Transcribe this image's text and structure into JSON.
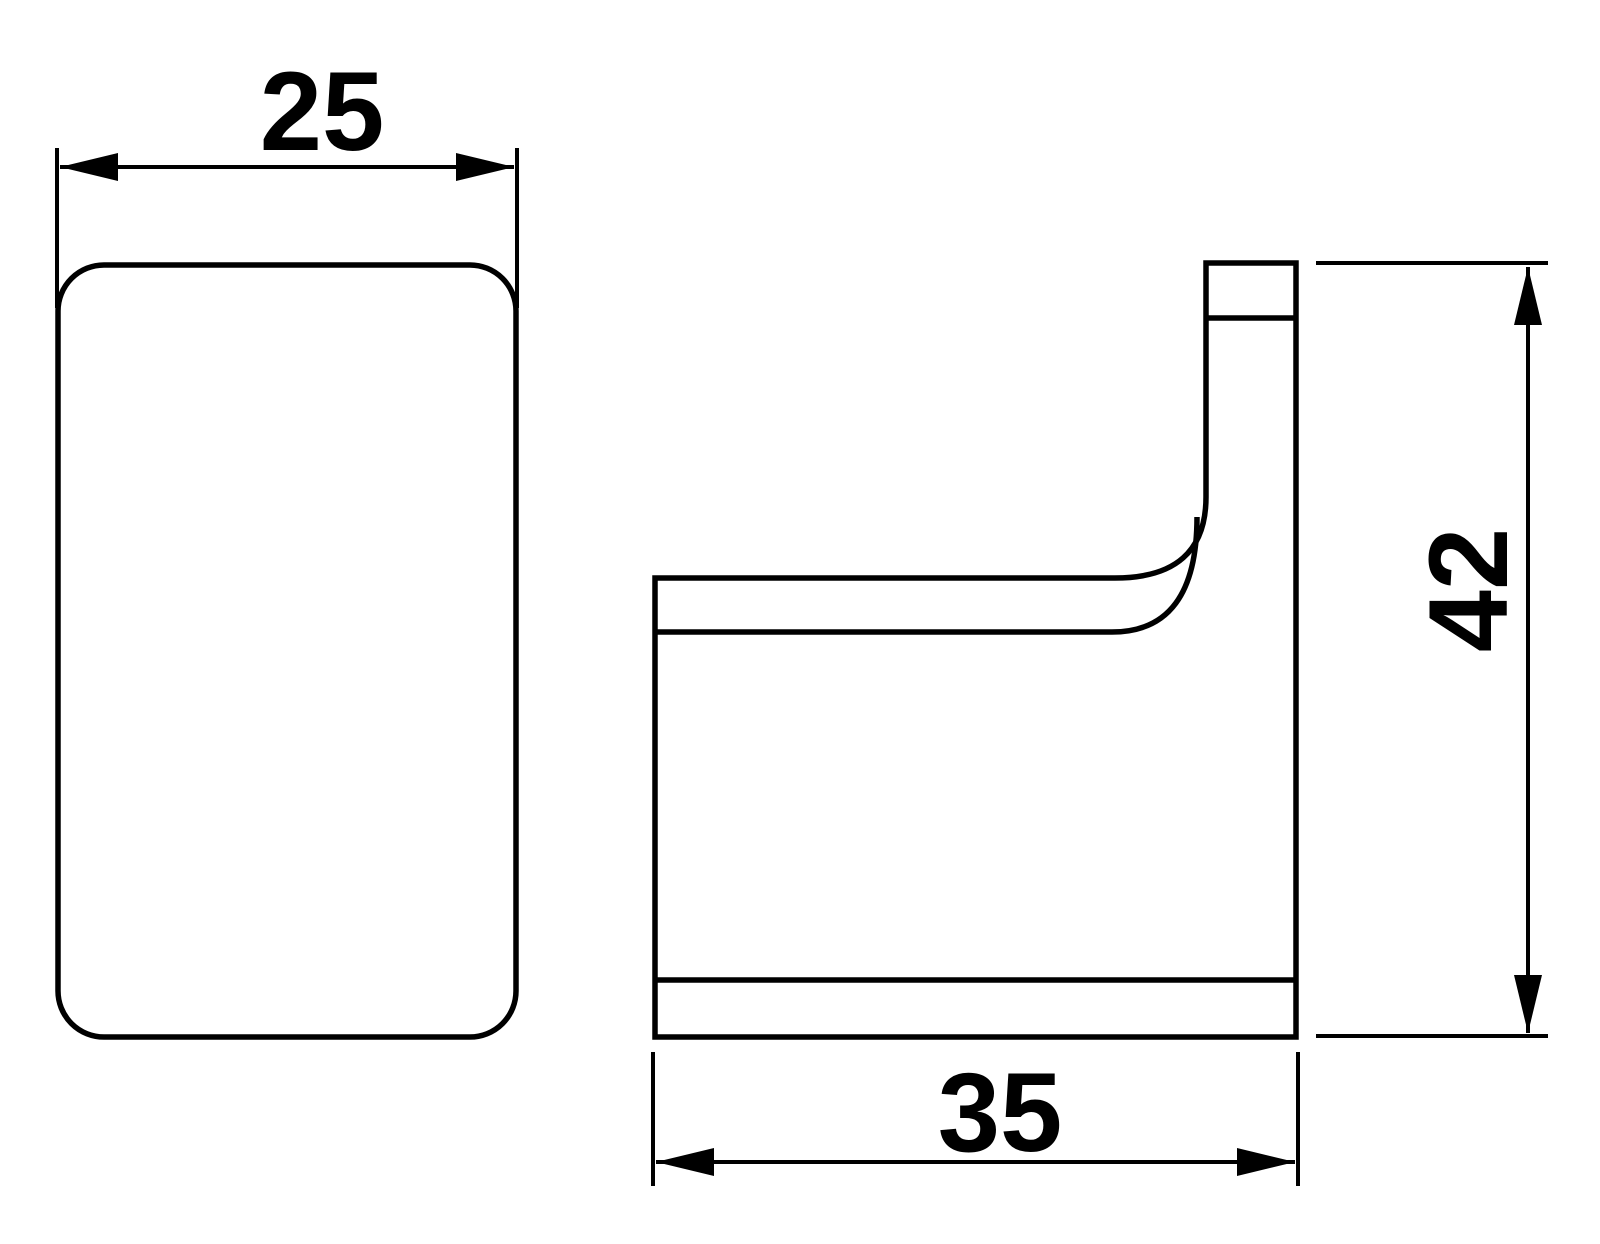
{
  "drawing": {
    "type": "technical-dimension-drawing",
    "subject": "wall hook - front and side orthographic views",
    "background_color": "#ffffff",
    "line_color": "#000000",
    "dimensions": {
      "front_width": {
        "label": "25"
      },
      "side_depth": {
        "label": "35"
      },
      "side_height": {
        "label": "42"
      }
    }
  }
}
